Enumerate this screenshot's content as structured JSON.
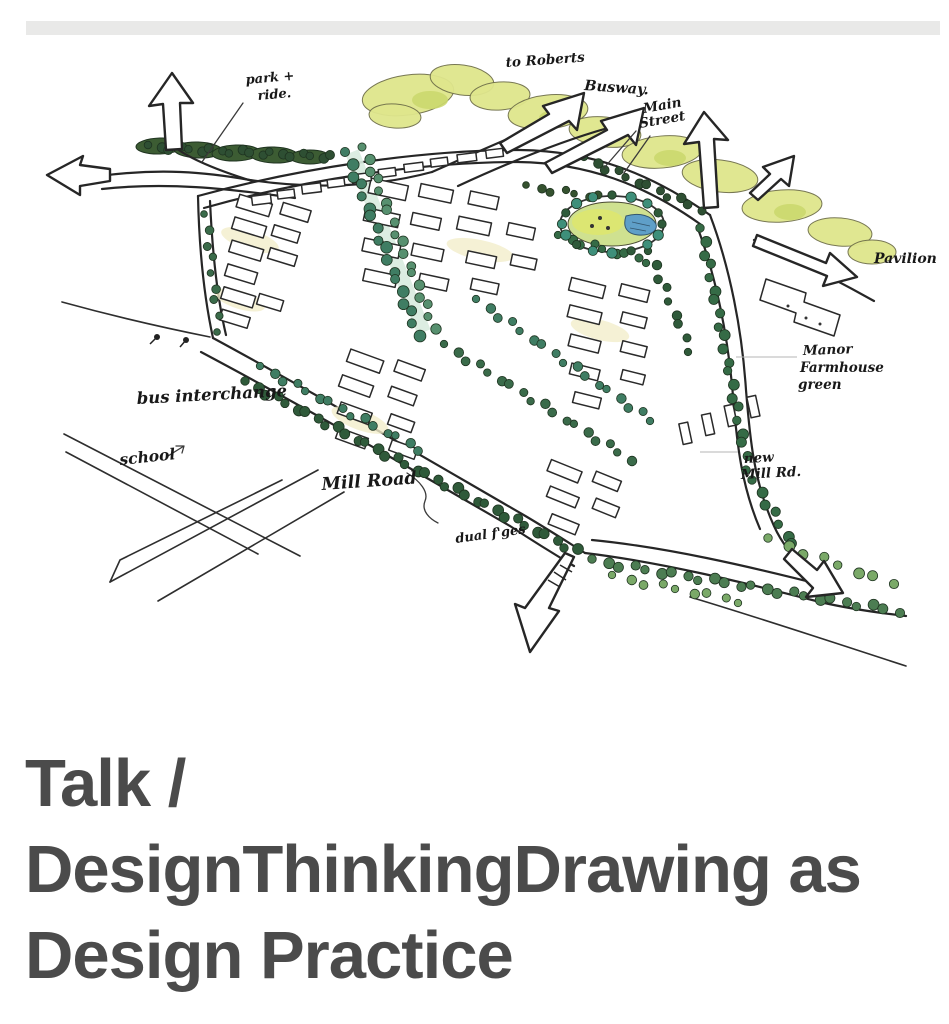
{
  "top_bar": {
    "color": "#e9e9e8"
  },
  "sketch": {
    "description": "Hand-drawn aerial masterplan sketch with annotations",
    "labels": {
      "park_ride_line1": "park +",
      "park_ride_line2": "ride.",
      "to_roberts": "to Roberts",
      "busway": "Busway.",
      "main_street_line1": "Main",
      "main_street_line2": "Street",
      "pavilion": "Pavilion",
      "manor_line1": "Manor",
      "manor_line2": "Farmhouse",
      "manor_line3": "green",
      "new_mill_line1": "new",
      "new_mill_line2": "Mill Rd.",
      "bus_interchange": "bus interchange",
      "school": "school",
      "mill_road": "Mill Road",
      "dual_frontages": "dual f'ges"
    },
    "colors": {
      "ink": "#262626",
      "tree_dark": "#2f5a3a",
      "tree_teal": "#3f7d63",
      "tree_light": "#7aa968",
      "canopy_yellow": "#dfe68c",
      "green_space": "#cfe190",
      "pond_blue": "#5f9fc8"
    }
  },
  "title": {
    "full": "Talk / DesignThinkingDrawing as Design Practice",
    "lines": [
      "Talk /",
      "DesignThinkingDrawing as",
      "Design Practice"
    ],
    "color": "#4b4b4b"
  }
}
